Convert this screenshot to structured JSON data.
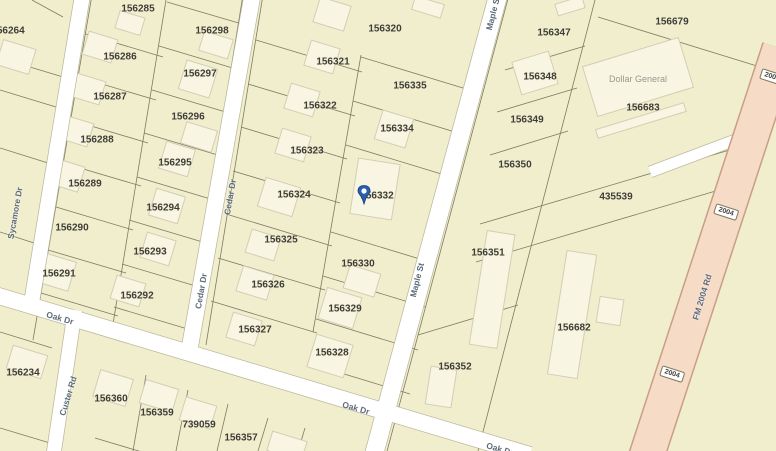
{
  "map": {
    "colors": {
      "background": "#f1eecd",
      "road": "#ffffff",
      "highway_fill": "#f6dbc6",
      "highway_casing": "#c99e85",
      "parcel_line": "#7e7a63",
      "building_fill": "#f8f5e2",
      "parcel_label": "#3d3d35",
      "street_label": "#5d6b7a",
      "pin_blue": "#2b5fae"
    },
    "parcels": [
      {
        "label": "156264",
        "x": 8,
        "y": 31
      },
      {
        "label": "156285",
        "x": 138,
        "y": 9
      },
      {
        "label": "156298",
        "x": 212,
        "y": 31
      },
      {
        "label": "156286",
        "x": 120,
        "y": 57
      },
      {
        "label": "156297",
        "x": 200,
        "y": 74
      },
      {
        "label": "156287",
        "x": 110,
        "y": 97
      },
      {
        "label": "156296",
        "x": 188,
        "y": 117
      },
      {
        "label": "156288",
        "x": 97,
        "y": 140
      },
      {
        "label": "156295",
        "x": 175,
        "y": 163
      },
      {
        "label": "156289",
        "x": 85,
        "y": 184
      },
      {
        "label": "156294",
        "x": 163,
        "y": 208
      },
      {
        "label": "156290",
        "x": 72,
        "y": 228
      },
      {
        "label": "156293",
        "x": 150,
        "y": 252
      },
      {
        "label": "156291",
        "x": 59,
        "y": 274
      },
      {
        "label": "156292",
        "x": 137,
        "y": 296
      },
      {
        "label": "156320",
        "x": 385,
        "y": 29
      },
      {
        "label": "156321",
        "x": 333,
        "y": 62
      },
      {
        "label": "156335",
        "x": 410,
        "y": 86
      },
      {
        "label": "156322",
        "x": 320,
        "y": 106
      },
      {
        "label": "156334",
        "x": 397,
        "y": 129
      },
      {
        "label": "156323",
        "x": 307,
        "y": 151
      },
      {
        "label": "156324",
        "x": 294,
        "y": 195
      },
      {
        "label": "156332",
        "x": 377,
        "y": 196
      },
      {
        "label": "156325",
        "x": 281,
        "y": 240
      },
      {
        "label": "156330",
        "x": 358,
        "y": 264
      },
      {
        "label": "156326",
        "x": 268,
        "y": 285
      },
      {
        "label": "156329",
        "x": 345,
        "y": 309
      },
      {
        "label": "156327",
        "x": 255,
        "y": 330
      },
      {
        "label": "156328",
        "x": 332,
        "y": 353
      },
      {
        "label": "156347",
        "x": 554,
        "y": 33
      },
      {
        "label": "156679",
        "x": 672,
        "y": 22
      },
      {
        "label": "156348",
        "x": 540,
        "y": 77
      },
      {
        "label": "156683",
        "x": 643,
        "y": 108
      },
      {
        "label": "156349",
        "x": 527,
        "y": 120
      },
      {
        "label": "156350",
        "x": 515,
        "y": 165
      },
      {
        "label": "435539",
        "x": 616,
        "y": 197
      },
      {
        "label": "156351",
        "x": 488,
        "y": 253
      },
      {
        "label": "156682",
        "x": 574,
        "y": 328
      },
      {
        "label": "156352",
        "x": 455,
        "y": 367
      },
      {
        "label": "156234",
        "x": 23,
        "y": 373
      },
      {
        "label": "156360",
        "x": 111,
        "y": 399
      },
      {
        "label": "156359",
        "x": 157,
        "y": 413
      },
      {
        "label": "739059",
        "x": 199,
        "y": 425
      },
      {
        "label": "156357",
        "x": 241,
        "y": 438
      }
    ],
    "pois": [
      {
        "label": "Dollar General",
        "x": 638,
        "y": 79
      }
    ],
    "streets": [
      {
        "name": "Sycamore Dr",
        "x": 15,
        "y": 213,
        "rot": -80
      },
      {
        "name": "Custer Rd",
        "x": 68,
        "y": 396,
        "rot": -73
      },
      {
        "name": "Cedar Dr",
        "x": 230,
        "y": 197,
        "rot": -80
      },
      {
        "name": "Cedar Dr",
        "x": 201,
        "y": 291,
        "rot": -80
      },
      {
        "name": "Oak Dr",
        "x": 60,
        "y": 318,
        "rot": 16
      },
      {
        "name": "Oak Dr",
        "x": 356,
        "y": 408,
        "rot": 16
      },
      {
        "name": "Oak Dr",
        "x": 500,
        "y": 449,
        "rot": 16
      },
      {
        "name": "Maple St",
        "x": 493,
        "y": 13,
        "rot": -76
      },
      {
        "name": "Maple St",
        "x": 417,
        "y": 280,
        "rot": -76
      },
      {
        "name": "FM 2004 Rd",
        "x": 702,
        "y": 297,
        "rot": -73
      }
    ],
    "route_shields": [
      {
        "label": "2004",
        "x": 772,
        "y": 77,
        "rot": 18
      },
      {
        "label": "2004",
        "x": 726,
        "y": 212,
        "rot": 18
      },
      {
        "label": "2004",
        "x": 672,
        "y": 374,
        "rot": 18
      }
    ],
    "pin": {
      "parcel": "156332",
      "x": 364,
      "y": 195
    }
  }
}
